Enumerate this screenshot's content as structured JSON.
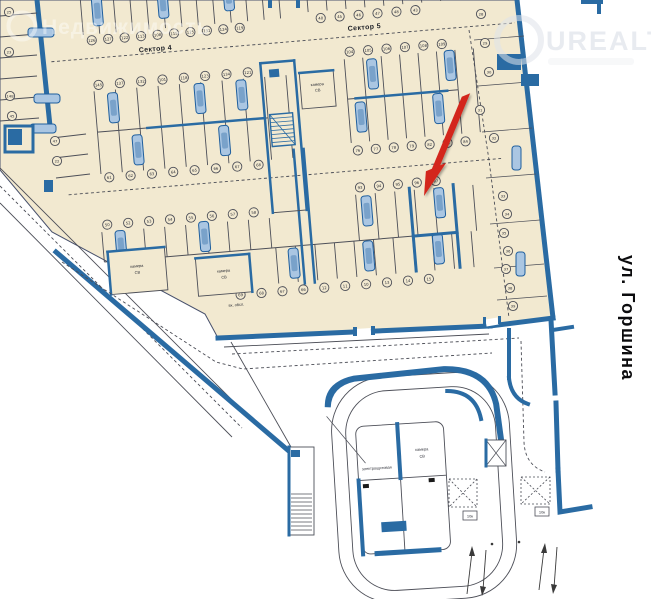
{
  "plan": {
    "sector_labels": {
      "sector4": "Сектор 4",
      "sector5": "Сектор 5"
    },
    "street_label": "ул. Горшина",
    "room_labels": {
      "camera_line1": "камера",
      "camera_line2": "СВ",
      "electrical": "электрощитовая",
      "service_entrance": "вх. обсл."
    },
    "small_box_labels": [
      "10к",
      "10к"
    ],
    "stall_rows": {
      "left_column": [
        "25",
        "23",
        "148",
        "45",
        "47",
        "22"
      ],
      "sector4_top": [
        "126",
        "127",
        "122",
        "113",
        "108",
        "115",
        "125",
        "131",
        "124",
        "119"
      ],
      "sector5_top": [
        "40",
        "45",
        "46",
        "47",
        "48",
        "43"
      ],
      "sector4_mid_upper": [
        "145",
        "137",
        "132",
        "101",
        "118",
        "123",
        "134",
        "121"
      ],
      "sector4_mid_lower": [
        "61",
        "62",
        "63",
        "64",
        "65",
        "66",
        "67",
        "68"
      ],
      "sector5_mid_upper": [
        "104",
        "105",
        "106",
        "107",
        "108",
        "109"
      ],
      "sector5_mid_lower": [
        "76",
        "77",
        "78",
        "79",
        "82",
        "83",
        "84"
      ],
      "sector4_bot_upper": [
        "50",
        "52",
        "53",
        "54",
        "55",
        "56",
        "57",
        "58"
      ],
      "sector5_bot_upper": [
        "93",
        "94",
        "95",
        "96",
        "97"
      ],
      "bottom_edge": [
        "69",
        "68",
        "67",
        "66",
        "12",
        "11",
        "10",
        "13",
        "14",
        "15"
      ],
      "right_inner": [
        "28",
        "29",
        "30",
        "31",
        "32"
      ],
      "right_edge": [
        "33",
        "34",
        "35",
        "36",
        "37",
        "38",
        "39"
      ]
    },
    "highlight_arrow": {
      "color": "#d3261b",
      "target_stall": "96"
    },
    "colors": {
      "floor": "#f2e9d0",
      "wall": "#2a6ba3",
      "line": "#4d4f58",
      "car_fill": "#aac6e2",
      "car_stroke": "#1f5f9e",
      "arrow": "#d3261b"
    }
  },
  "watermarks": {
    "left": "Недвижимость",
    "right": "UREALT"
  }
}
